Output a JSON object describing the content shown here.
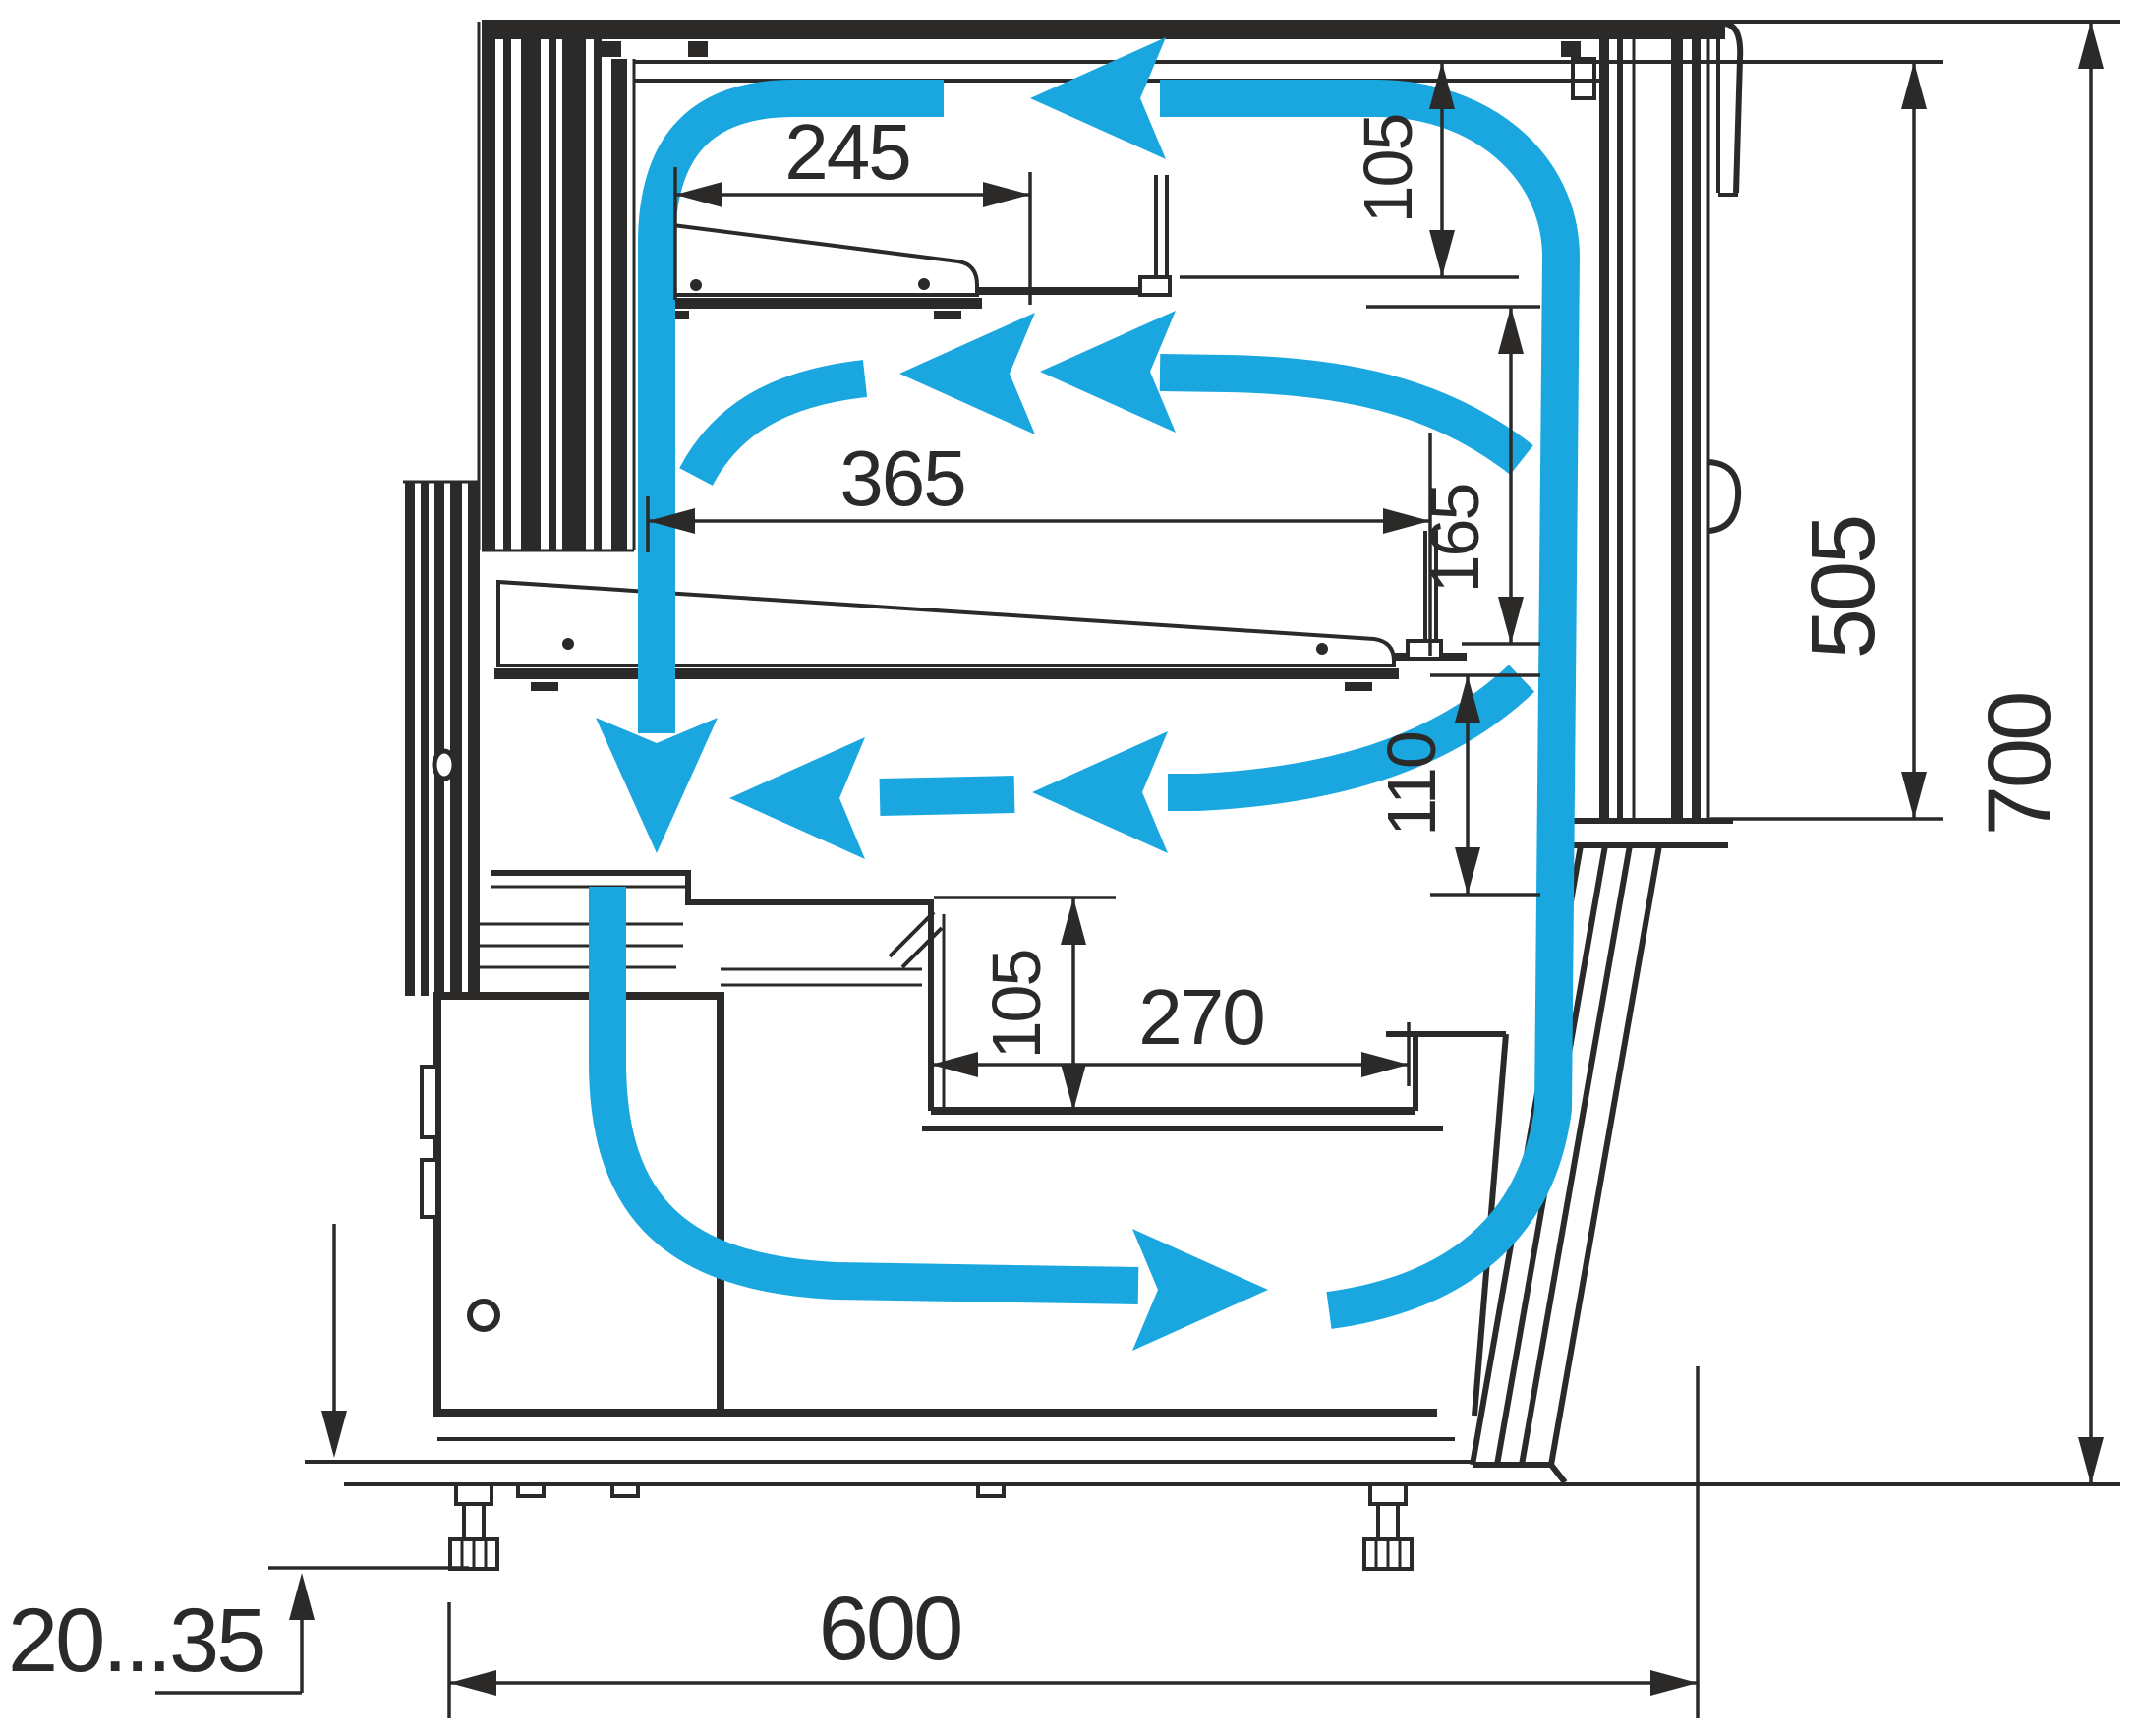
{
  "colors": {
    "airflow_blue": "#1aa7e0",
    "line_dark": "#2b2a29",
    "background": "#ffffff"
  },
  "dimensions": {
    "upper_shelf_depth": "245",
    "canopy_to_shelf_gap": "105",
    "middle_shelf_depth": "365",
    "upper_shelf_gap": "165",
    "lower_shelf_gap": "110",
    "well_depth": "105",
    "well_width": "270",
    "front_glass_height": "505",
    "overall_height": "700",
    "overall_depth": "600",
    "leg_adjustment_range": "20...35"
  }
}
